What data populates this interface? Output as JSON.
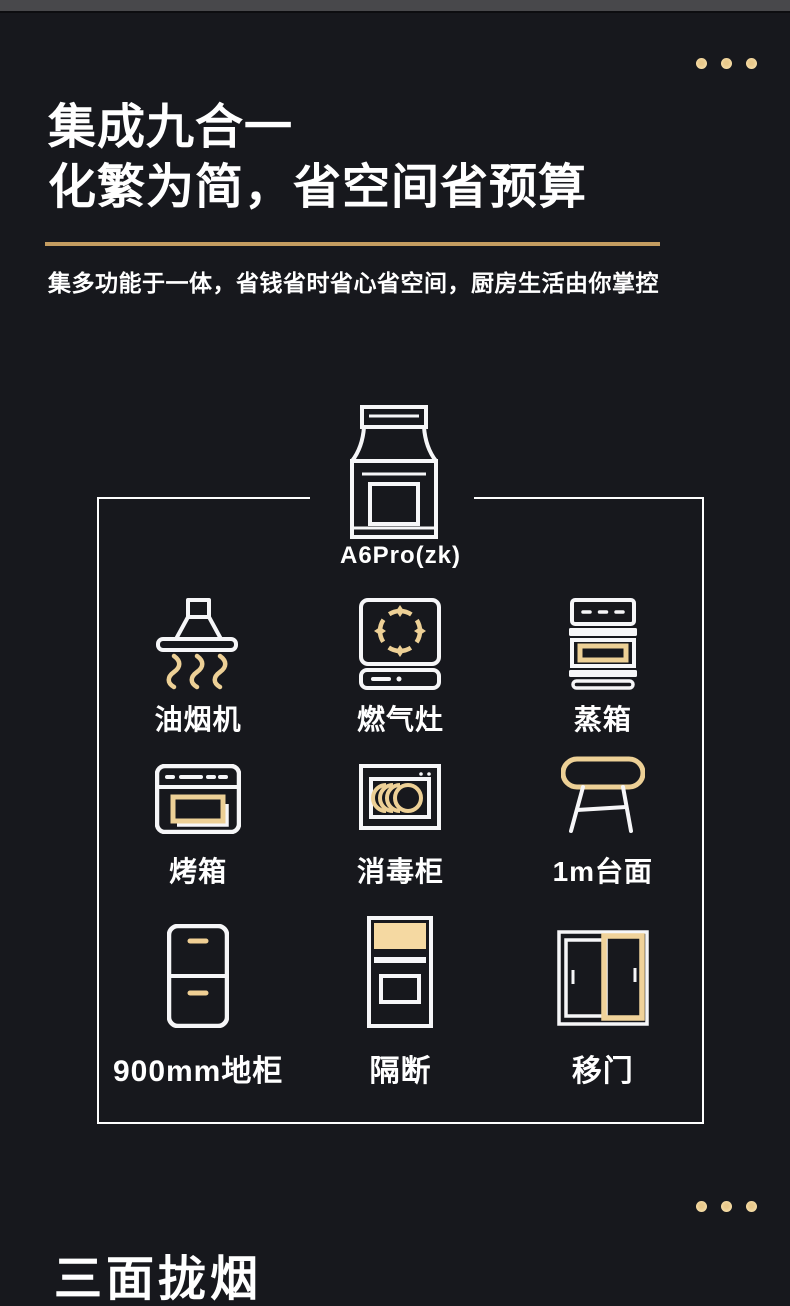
{
  "colors": {
    "background": "#17181d",
    "white": "#ffffff",
    "gold_stroke": "#edd096",
    "gold_fill": "#f5d9a2",
    "underline_gold": "#c49c60",
    "dot_gold": "#f1d49c",
    "top_strip": "#48484b"
  },
  "header": {
    "title_line1": "集成九合一",
    "title_line2": "化繁为简，省空间省预算",
    "subtitle": "集多功能于一体，省钱省时省心省空间，厨房生活由你掌控"
  },
  "product": {
    "model_label": "A6Pro(zk)"
  },
  "grid": {
    "items": [
      {
        "label": "油烟机",
        "icon": "range-hood-icon"
      },
      {
        "label": "燃气灶",
        "icon": "gas-stove-icon"
      },
      {
        "label": "蒸箱",
        "icon": "steam-oven-icon"
      },
      {
        "label": "烤箱",
        "icon": "oven-icon"
      },
      {
        "label": "消毒柜",
        "icon": "disinfection-cabinet-icon"
      },
      {
        "label": "1m台面",
        "icon": "countertop-icon"
      },
      {
        "label": "900mm地柜",
        "icon": "floor-cabinet-icon"
      },
      {
        "label": "隔断",
        "icon": "partition-icon"
      },
      {
        "label": "移门",
        "icon": "sliding-door-icon"
      }
    ]
  },
  "footer": {
    "partial_next_heading": "三面拢烟"
  }
}
